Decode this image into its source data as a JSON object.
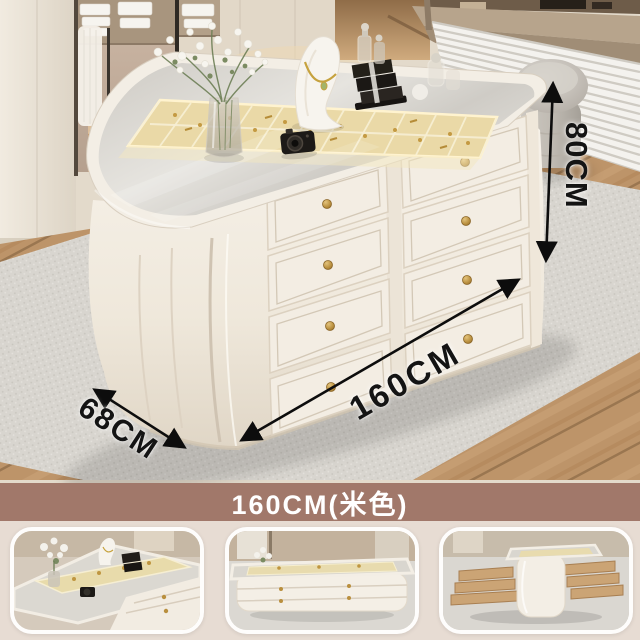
{
  "photo": {
    "scene": "cream jewelry display island in dressing room",
    "dimensions": {
      "height": {
        "label": "80CM"
      },
      "length": {
        "label": "160CM"
      },
      "depth": {
        "label": "68CM"
      }
    }
  },
  "banner": {
    "label": "160CM(米色)",
    "background": "#a1786a",
    "text_color": "#ffffff"
  },
  "thumbnails": [
    {
      "name": "glass-top-jewelry-close-up"
    },
    {
      "name": "island-side-view"
    },
    {
      "name": "island-open-drawers-view"
    }
  ],
  "colors": {
    "cabinet_cream": "#f2ece2",
    "glass_top": "#d9d6d0",
    "tray_gold": "#e9dcae",
    "knob_brass": "#b98f3e",
    "rug_gray": "#d7d4ce",
    "wood_floor": "#bd9469",
    "banner_brown": "#a1786a",
    "page_background": "#e7dcd3",
    "annotation_black": "#141414"
  }
}
